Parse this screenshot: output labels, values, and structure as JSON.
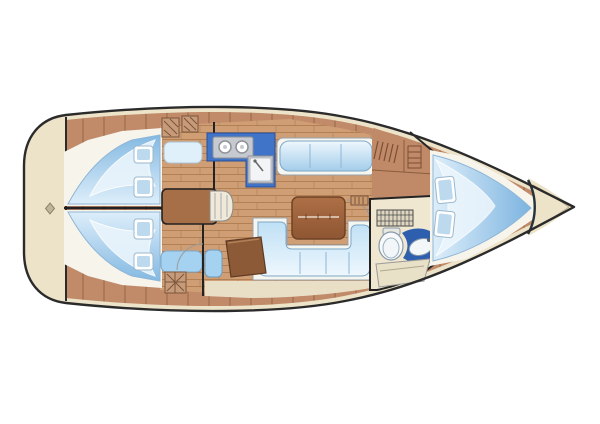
{
  "title": "Sailing yacht interior floor plan",
  "diagram": {
    "type": "boat-floor-plan",
    "view": "top-down",
    "bow_direction": "right",
    "stern_direction": "left",
    "rooms": [
      {
        "name": "stern-deck",
        "features": [
          "transom",
          "stern-marker-diamond"
        ]
      },
      {
        "name": "aft-cabin-port",
        "features": [
          "double-berth-mattress",
          "two-pillows",
          "seat-cushion",
          "hatched-lockers"
        ]
      },
      {
        "name": "aft-cabin-starboard",
        "features": [
          "double-berth-mattress",
          "two-pillows",
          "seat-cushion",
          "floor-grate"
        ]
      },
      {
        "name": "companionway",
        "features": [
          "engine-box",
          "steps"
        ]
      },
      {
        "name": "galley",
        "features": [
          "l-shaped-counter",
          "two-burner-stove",
          "sink"
        ]
      },
      {
        "name": "saloon",
        "features": [
          "straight-settee",
          "u-shaped-settee",
          "folding-table",
          "teak-floor"
        ]
      },
      {
        "name": "nav-station",
        "features": [
          "chart-table",
          "seat-cushion"
        ]
      },
      {
        "name": "head-compartment",
        "features": [
          "shower-grate",
          "toilet",
          "vanity-counter",
          "sink",
          "bench"
        ]
      },
      {
        "name": "wardrobe",
        "features": [
          "hanging-locker",
          "shelves"
        ]
      },
      {
        "name": "fore-cabin",
        "features": [
          "v-berth-mattress",
          "two-pillows"
        ]
      },
      {
        "name": "anchor-locker",
        "features": [
          "bow-bulkhead-curve"
        ]
      }
    ]
  },
  "colors": {
    "background": "#ffffff",
    "hull_outline": "#2b2b2b",
    "deck_cream": "#ece3c9",
    "locker_cream": "#e9dfc6",
    "side_deck_wood": "#c18a69",
    "side_deck_seam": "#9e6e4d",
    "floor_wood": "#cf9e74",
    "floor_plank_line": "#b28052",
    "berth_base": "#f7f4ec",
    "mattress_deep": "#84b9e2",
    "mattress_light": "#ddeefa",
    "cushion_deep": "#a3cdea",
    "cushion_light": "#eef7fd",
    "pillow_white": "#ffffff",
    "pillow_inner": "#bcd9ee",
    "bench_blue": "#a5d2f0",
    "galley_counter_blue": "#3f74c9",
    "appliance_gray": "#c6c9cf",
    "table_brown": "#9b603c",
    "table_edge": "#6f4226",
    "nav_table_brown": "#8d5a38",
    "companionway_brown": "#a76f47",
    "cabinet_wood": "#c08a68",
    "head_floor": "#efe7d0",
    "head_counter_blue": "#2e5fae",
    "fixture_white": "#f7f9fa",
    "swing_arc_gray": "#9a9a9a"
  }
}
